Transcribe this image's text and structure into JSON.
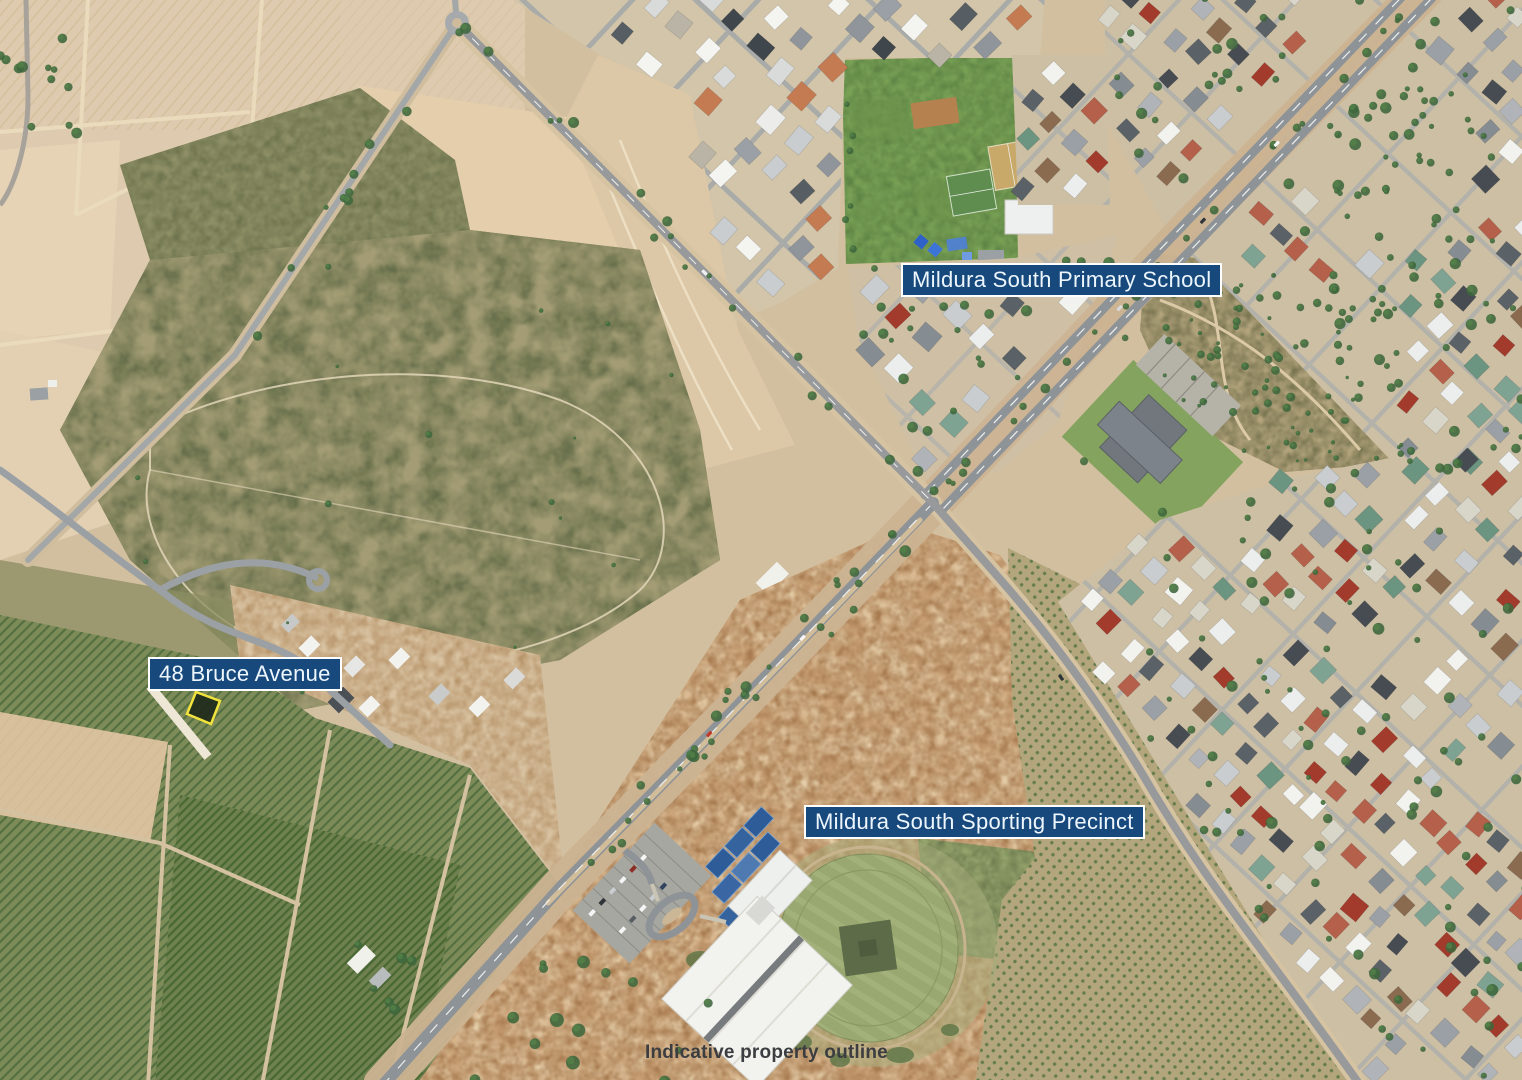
{
  "labels": {
    "school": {
      "text": "Mildura South Primary School",
      "type": "callout-box"
    },
    "property": {
      "text": "48 Bruce Avenue",
      "type": "callout-box"
    },
    "precinct": {
      "text": "Mildura South Sporting Precinct",
      "type": "callout-box"
    },
    "caption": {
      "text": "Indicative property outline",
      "type": "plain-text"
    }
  },
  "annotations": {
    "property_outline": {
      "label": "48 Bruce Avenue lot",
      "outline_color": "#f2e43c",
      "shape": "rotated-rectangle"
    }
  },
  "colors": {
    "label_background": "#17497d",
    "label_border": "#ffffff",
    "label_text": "#eef6fd",
    "caption_text": "#3b3d40"
  }
}
